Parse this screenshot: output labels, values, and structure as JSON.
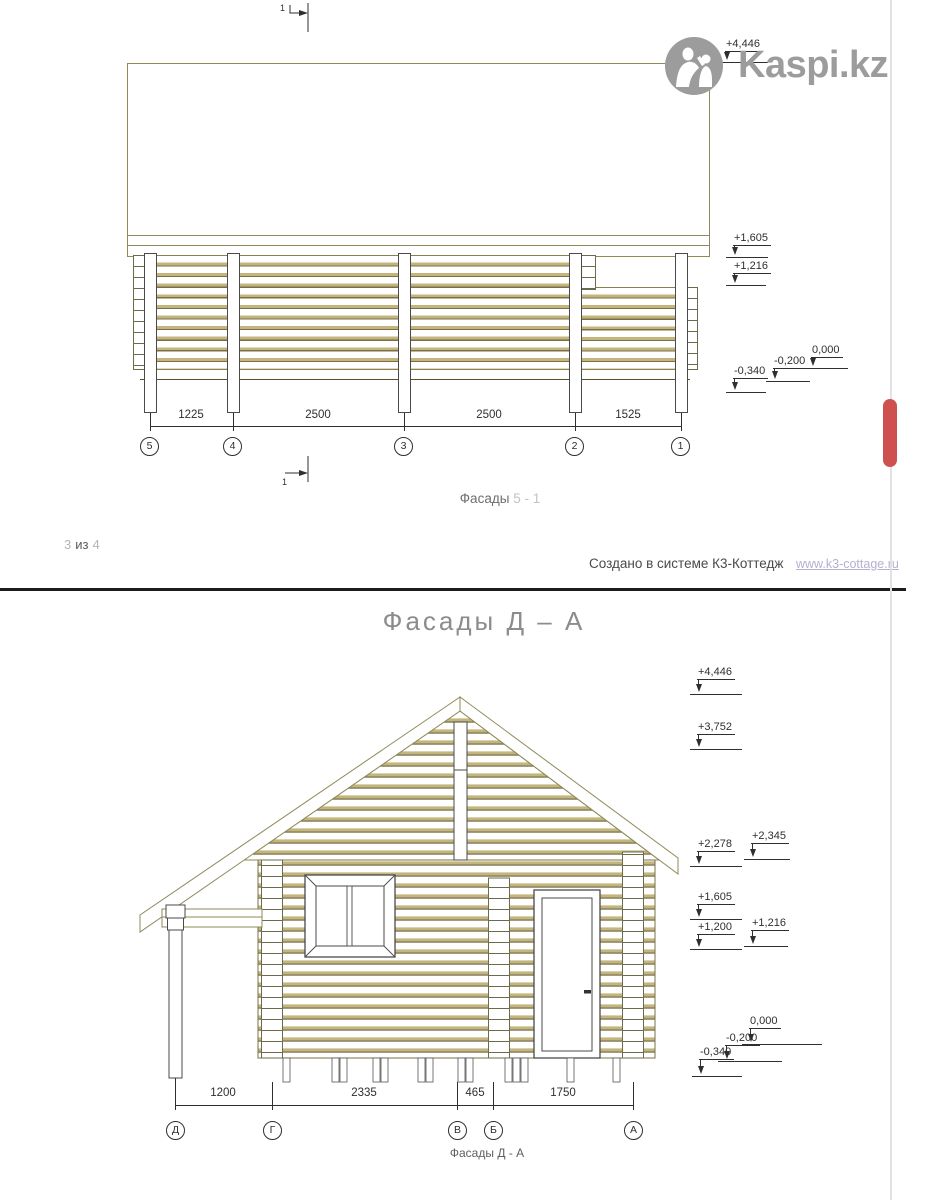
{
  "watermark": {
    "brand": "Kaspi.kz"
  },
  "ui": {
    "scroll_thumb_color": "#ce5150",
    "accent_olive": "#8f8a58"
  },
  "page1": {
    "section_marker": "1",
    "levels": [
      "+4,446",
      "+1,605",
      "+1,216",
      "0,000",
      "-0,200",
      "-0,340"
    ],
    "dims": [
      "1225",
      "2500",
      "2500",
      "1525"
    ],
    "axes": [
      "5",
      "4",
      "3",
      "2",
      "1"
    ],
    "caption": {
      "prefix": "Фасады",
      "suffix": "5 - 1"
    },
    "footer": {
      "page_current": "3",
      "page_of": "из",
      "page_total": "4",
      "created": "Создано в системе К3-Коттедж",
      "link": "www.k3-cottage.ru"
    }
  },
  "page2": {
    "title": "Фасады Д – А",
    "levels": [
      "+4,446",
      "+3,752",
      "+2,278",
      "+2,345",
      "+1,605",
      "+1,200",
      "+1,216",
      "0,000",
      "-0,200",
      "-0,340"
    ],
    "dims": [
      "1200",
      "2335",
      "465",
      "1750"
    ],
    "axes": [
      "Д",
      "Г",
      "В",
      "Б",
      "А"
    ],
    "caption": "Фасады Д - А"
  }
}
